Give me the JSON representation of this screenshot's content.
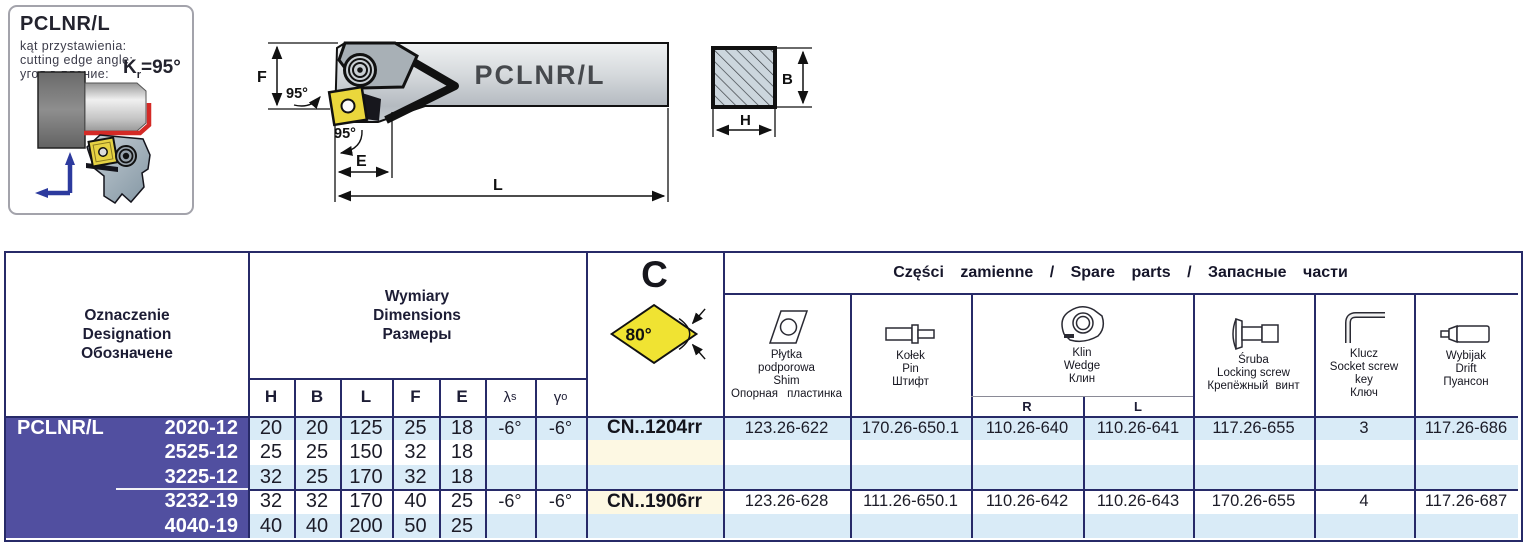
{
  "info_box": {
    "title": "PCLNR/L",
    "line1": "kąt przystawienia:",
    "line2": "cutting edge angle:",
    "line3": "угол в плание:",
    "kr_symbol": "K",
    "kr_sub": "r",
    "kr_value": "=95°"
  },
  "drawing": {
    "tool_label": "PCLNR/L",
    "angle_top": "95°",
    "angle_bottom": "95°",
    "dim_f": "F",
    "dim_e": "E",
    "dim_l": "L",
    "dim_b": "B",
    "dim_h": "H"
  },
  "table": {
    "designation": {
      "l1": "Oznaczenie",
      "l2": "Designation",
      "l3": "Обозначене"
    },
    "dimensions": {
      "l1": "Wymiary",
      "l2": "Dimensions",
      "l3": "Размеры"
    },
    "dim_cols": {
      "h": "H",
      "b": "B",
      "l": "L",
      "f": "F",
      "e": "E",
      "lambda": "λ",
      "lambda_sub": "s",
      "gamma": "γ",
      "gamma_sub": "o"
    },
    "insert_letter": "C",
    "insert_angle": "80°",
    "spare_title": "Części zamienne / Spare parts / Запасные части",
    "shim": {
      "l1": "Płytka",
      "l2": "podporowa",
      "l3": "Shim",
      "l4": "Опорная пластинка"
    },
    "pin": {
      "l1": "Kołek",
      "l2": "Pin",
      "l3": "Штифт"
    },
    "wedge": {
      "l1": "Klin",
      "l2": "Wedge",
      "l3": "Клин",
      "r": "R",
      "l": "L"
    },
    "screw": {
      "l1": "Śruba",
      "l2": "Locking screw",
      "l3": "Крепёжный винт"
    },
    "key": {
      "l1": "Klucz",
      "l2": "Socket screw",
      "l3": "key",
      "l4": "Ключ"
    },
    "drift": {
      "l1": "Wybijak",
      "l2": "Drift",
      "l3": "Пуансон"
    },
    "family": "PCLNR/L",
    "rows": [
      {
        "size": "2020-12",
        "h": "20",
        "b": "20",
        "l": "125",
        "f": "25",
        "e": "18",
        "ls": "-6°",
        "go": "-6°",
        "insert": "CN..1204rr",
        "shim": "123.26-622",
        "pin": "170.26-650.1",
        "wedge_r": "110.26-640",
        "wedge_l": "110.26-641",
        "screw": "117.26-655",
        "key": "3",
        "drift": "117.26-686"
      },
      {
        "size": "2525-12",
        "h": "25",
        "b": "25",
        "l": "150",
        "f": "32",
        "e": "18"
      },
      {
        "size": "3225-12",
        "h": "32",
        "b": "25",
        "l": "170",
        "f": "32",
        "e": "18"
      },
      {
        "size": "3232-19",
        "h": "32",
        "b": "32",
        "l": "170",
        "f": "40",
        "e": "25",
        "ls": "-6°",
        "go": "-6°",
        "insert": "CN..1906rr",
        "shim": "123.26-628",
        "pin": "111.26-650.1",
        "wedge_r": "110.26-642",
        "wedge_l": "110.26-643",
        "screw": "170.26-655",
        "key": "4",
        "drift": "117.26-687"
      },
      {
        "size": "4040-19",
        "h": "40",
        "b": "40",
        "l": "200",
        "f": "50",
        "e": "25"
      }
    ]
  }
}
